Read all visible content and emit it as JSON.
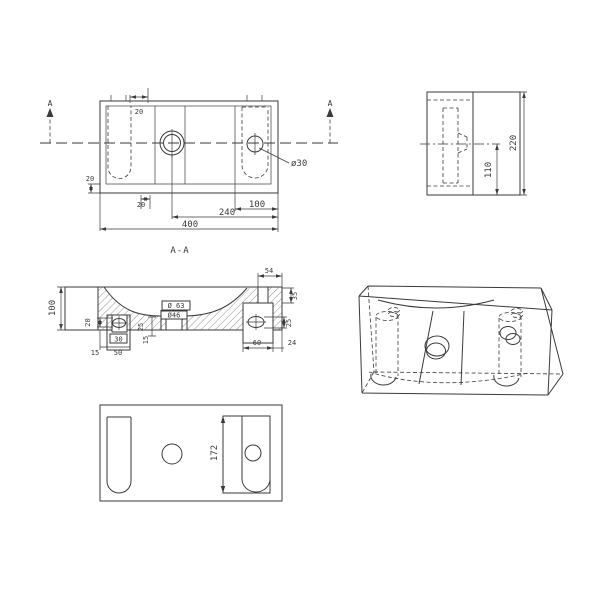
{
  "colors": {
    "line": "#3a3a3a",
    "background": "#ffffff"
  },
  "views": {
    "plan": {
      "section_marker_left": "A",
      "section_marker_right": "A",
      "hole_label": "ø30",
      "dims": {
        "top_20": "20",
        "left_20": "20",
        "bottom_20": "20",
        "d100": "100",
        "d240": "240",
        "d400": "400"
      }
    },
    "side": {
      "dims": {
        "d110": "110",
        "d220": "220"
      }
    },
    "section": {
      "title": "A-A",
      "drain": {
        "outer": "Ø 63",
        "inner": "Ø46"
      },
      "dims": {
        "d100": "100",
        "d20": "20",
        "d30": "30",
        "d15": "15",
        "d50": "50",
        "d25": "25",
        "d15b": "15",
        "d54": "54",
        "d35": "35",
        "d25b": "25",
        "d60": "60",
        "d24": "24"
      }
    },
    "bottom": {
      "dims": {
        "d172": "172"
      }
    }
  }
}
